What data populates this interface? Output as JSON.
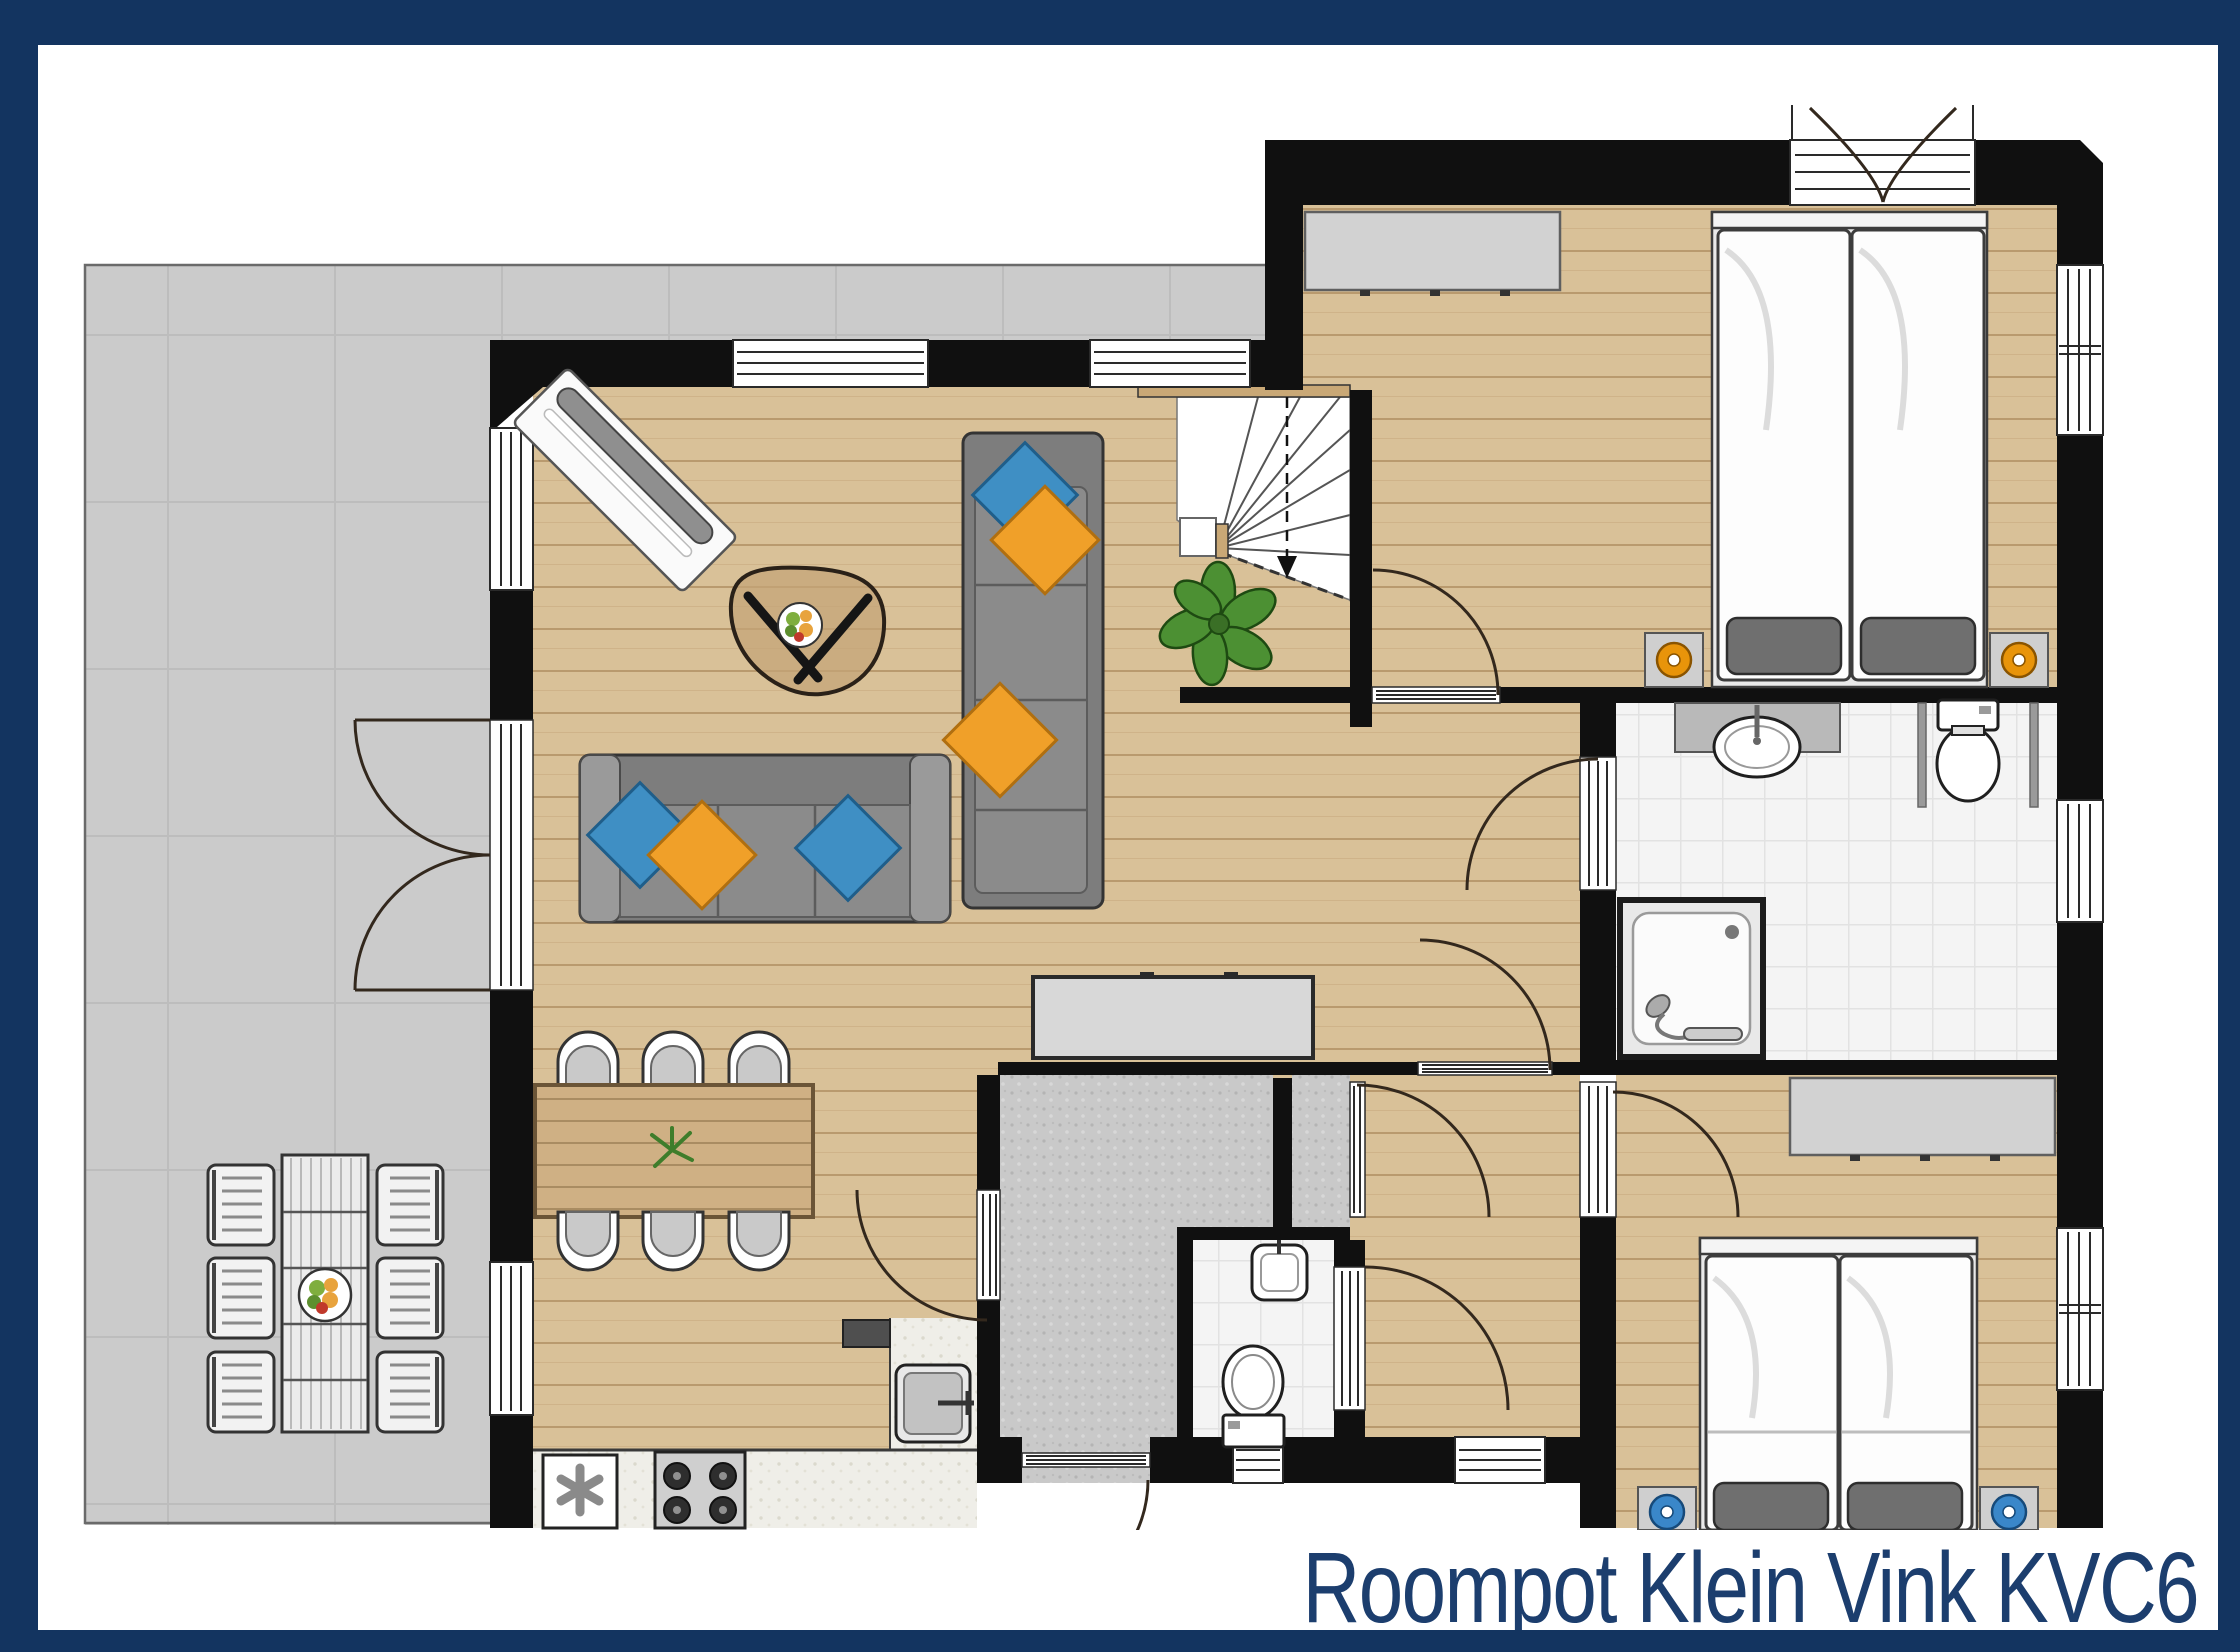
{
  "title": {
    "text": "Roompot Klein Vink KVC6",
    "color": "#1c3e6e"
  },
  "palette": {
    "border_navy": "#133460",
    "page_bg": "#ffffff",
    "wall_black": "#101010",
    "wood_floor": "#d9c198",
    "wood_plank_line": "#b99a6e",
    "terrace_gray": "#cbcbcb",
    "terrace_grid": "#bdbdbd",
    "hall_floor_speckle": "#c9c9c9",
    "tile_floor": "#f4f4f4",
    "kitchen_counter": "#efeee8",
    "sofa_gray": "#7d7d7d",
    "pillow_blue": "#3f8fc4",
    "pillow_orange": "#f0a029",
    "lamp_ring_orange": "#e8940a",
    "lamp_ring_blue": "#3a87c9",
    "plant_green": "#4c9033",
    "cabinet_gray": "#d8d8d8"
  },
  "floorplan": {
    "label": "Roompot Klein Vink KVC6",
    "rooms": [
      "terrace",
      "living-room",
      "dining-area",
      "kitchen",
      "entrance-hall",
      "staircase",
      "hallway",
      "wc",
      "bathroom",
      "corridor",
      "bedroom-1",
      "bedroom-2"
    ],
    "furniture": [
      "garden-chairs",
      "garden-table",
      "fruit-bowl",
      "french-doors",
      "radiator",
      "coffee-table",
      "chaise-sofa",
      "three-seat-sofa",
      "dining-table",
      "dining-chairs",
      "potted-plant",
      "kitchen-counter",
      "kitchen-sink",
      "stove",
      "boiler",
      "sideboard",
      "front-door",
      "wc-sink",
      "wc-toilet",
      "bathroom-sink",
      "bathroom-toilet",
      "shower",
      "wardrobes",
      "double-beds",
      "nightstands",
      "reading-lamps"
    ]
  }
}
